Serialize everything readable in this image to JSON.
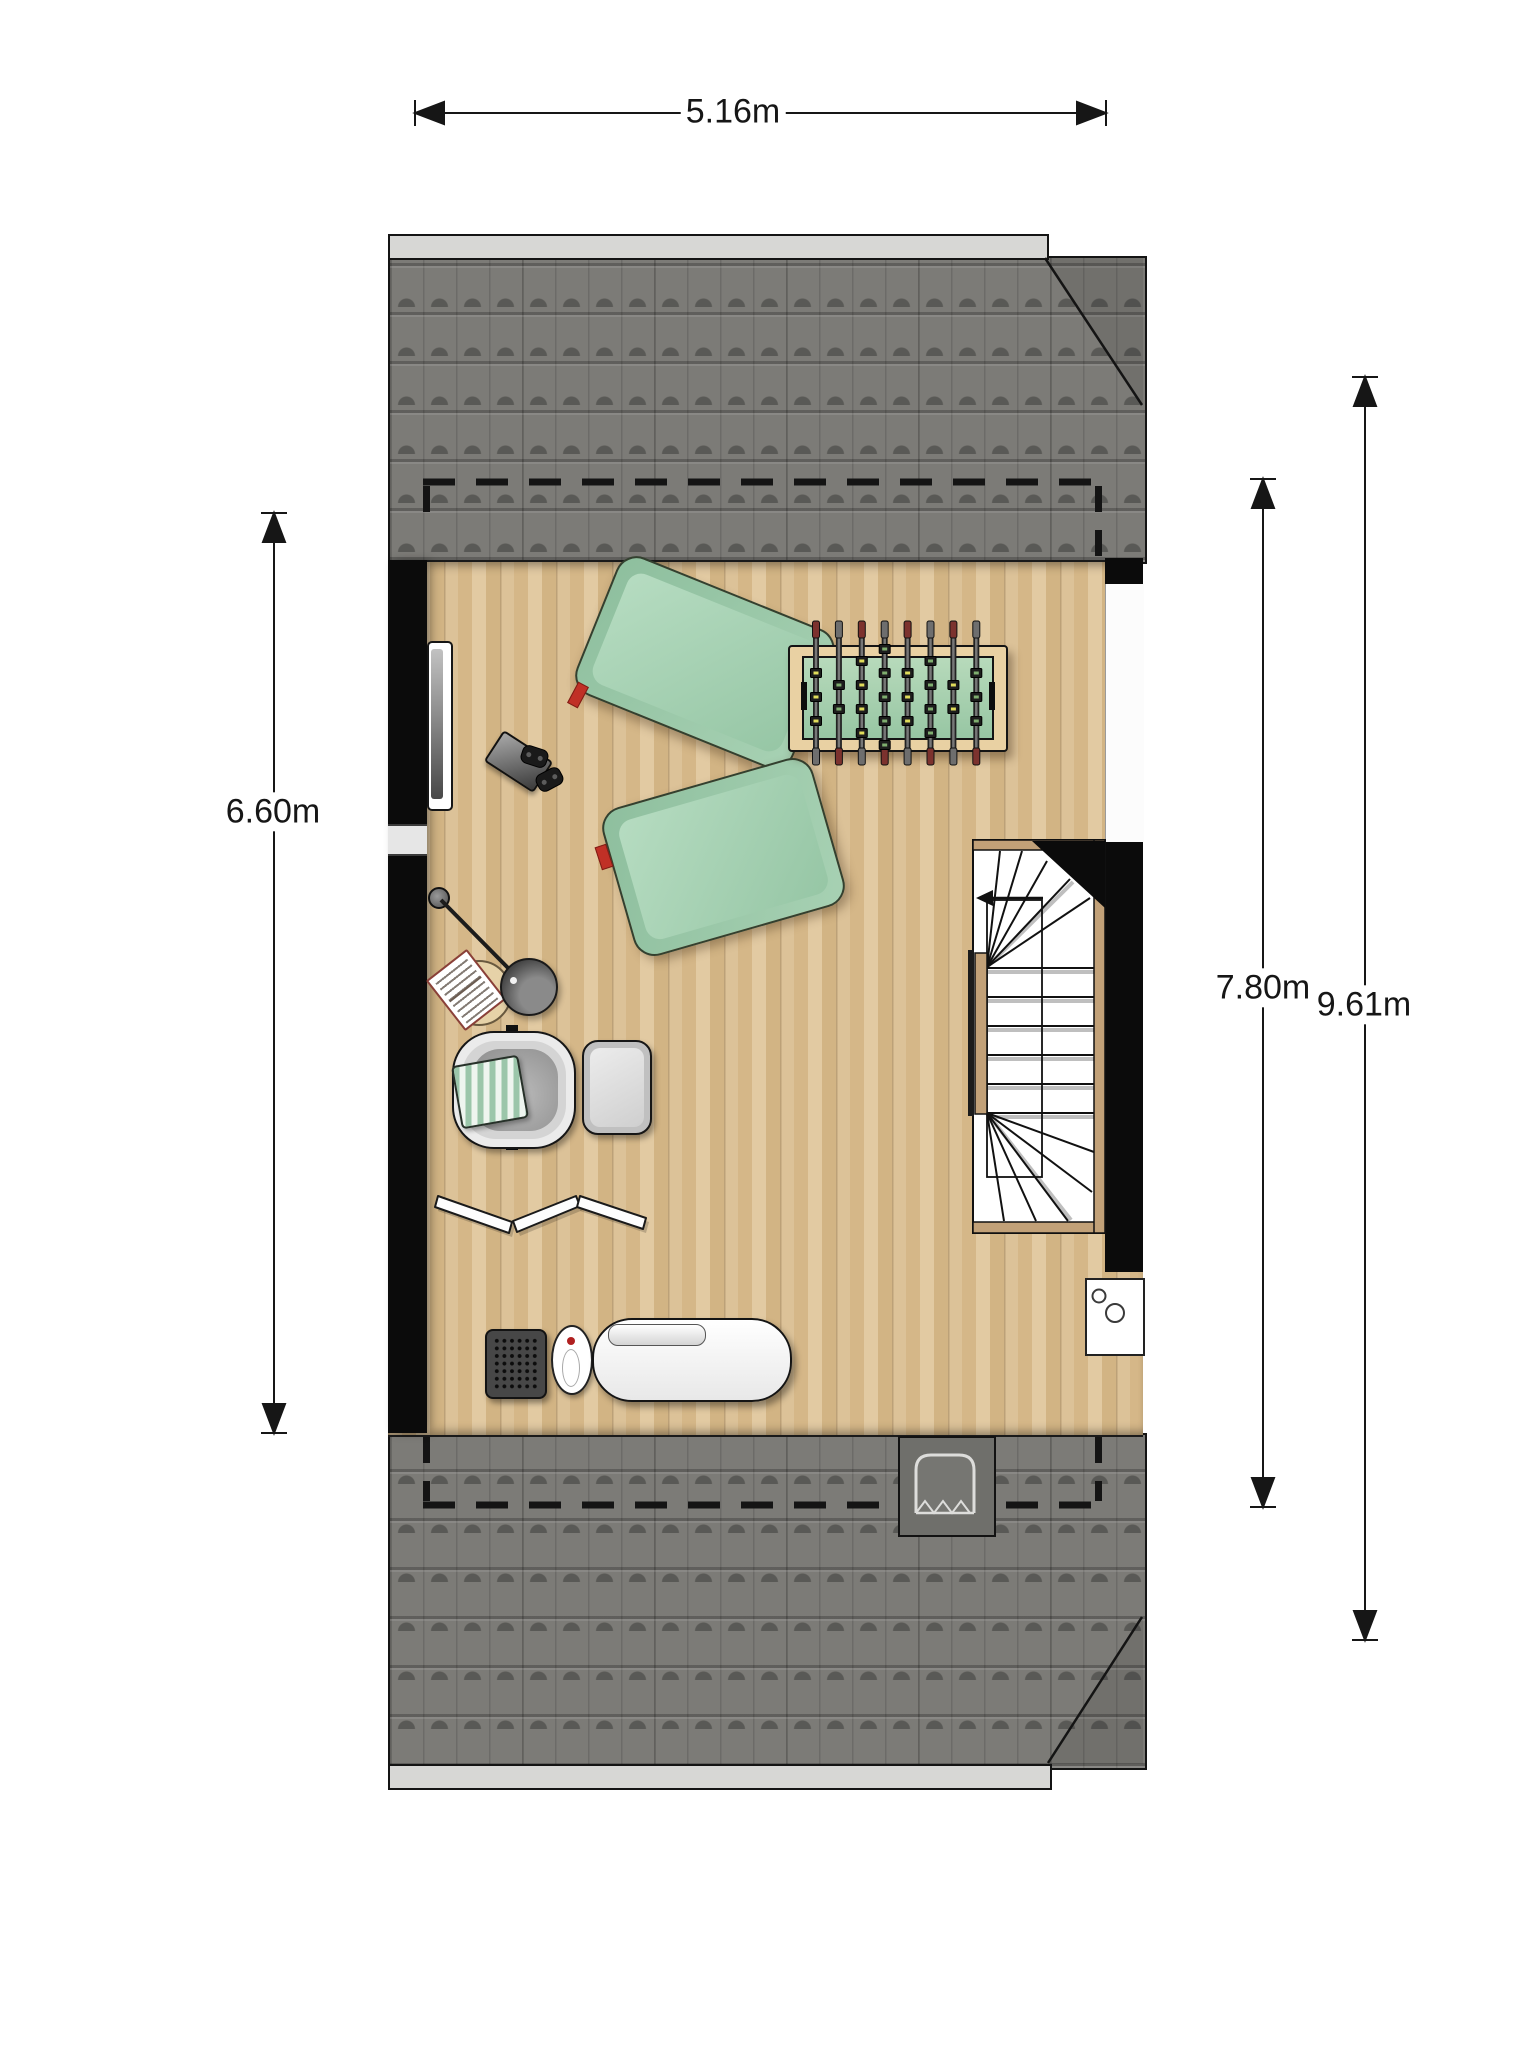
{
  "meta": {
    "type": "floor-plan",
    "level": "attic"
  },
  "dimensions": {
    "width_label": "5.16m",
    "left_height_label": "6.60m",
    "inner_height_label": "7.80m",
    "outer_height_label": "9.61m"
  },
  "palette": {
    "roof_tile": "#7c7b77",
    "roof_seam": "#595855",
    "ridge_strip": "#d7d7d5",
    "wood_floor": "#d9bd92",
    "wall": "#0b0b0b",
    "dimension_line": "#161616",
    "beanbag_green": "#9ccaa9",
    "accent_red": "#c03026",
    "foosball_frame": "#e9d1a3",
    "foosball_field": "#a8d2ae",
    "stair_trim": "#c2a178",
    "stair_tread": "#ffffff"
  },
  "furniture": [
    {
      "name": "tv"
    },
    {
      "name": "beanbag"
    },
    {
      "name": "beanbag"
    },
    {
      "name": "game-console"
    },
    {
      "name": "controller"
    },
    {
      "name": "controller"
    },
    {
      "name": "foosball-table"
    },
    {
      "name": "floor-lamp"
    },
    {
      "name": "magazine"
    },
    {
      "name": "side-table"
    },
    {
      "name": "armchair"
    },
    {
      "name": "ottoman"
    },
    {
      "name": "zigzag-lounger"
    },
    {
      "name": "speaker"
    },
    {
      "name": "vase"
    },
    {
      "name": "daybed"
    },
    {
      "name": "staircase"
    },
    {
      "name": "boiler"
    },
    {
      "name": "roof-window"
    }
  ],
  "foosball": {
    "rods": 8,
    "players_per_rod": [
      3,
      2,
      4,
      5,
      3,
      4,
      2,
      3
    ],
    "rod_x_start": 816,
    "rod_spacing": 22.9,
    "rod_top_y": 622,
    "rod_bottom_y": 762
  }
}
